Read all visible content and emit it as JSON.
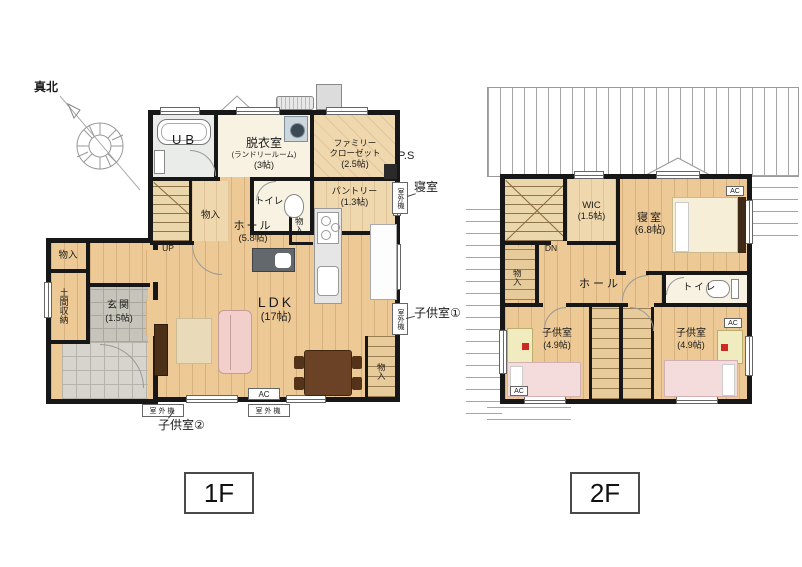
{
  "compass": {
    "north": "真北"
  },
  "tags": {
    "f1": "1F",
    "f2": "2F"
  },
  "f1": {
    "ub": "UB",
    "datsui": "脱衣室",
    "datsui_sub": "(ランドリールーム)",
    "datsui_size": "(3帖)",
    "famiclo1": "ファミリー",
    "famiclo2": "クローゼット",
    "famiclo_size": "(2.5帖)",
    "toilet": "トイレ",
    "pantry": "パントリー",
    "pantry_size": "(1.3帖)",
    "ps": "P.S",
    "monoire": "物入",
    "up": "UP",
    "hall": "ホール",
    "hall_size": "(5.8帖)",
    "doma": "土間収納",
    "genkan": "玄関",
    "genkan_size": "(1.5帖)",
    "ldk": "LDK",
    "ldk_size": "(17帖)",
    "ac": "AC",
    "outdoor": "室外機",
    "co_shinshitsu": "寝室",
    "co_kodomo1": "子供室①",
    "co_kodomo2": "子供室②"
  },
  "f2": {
    "dn": "DN",
    "wic": "WIC",
    "wic_size": "(1.5帖)",
    "shinshitsu": "寝室",
    "shinshitsu_size": "(6.8帖)",
    "monoire": "物入",
    "hall": "ホール",
    "toilet": "トイレ",
    "kodomo": "子供室",
    "kodomo_size": "(4.9帖)",
    "ac": "AC"
  }
}
